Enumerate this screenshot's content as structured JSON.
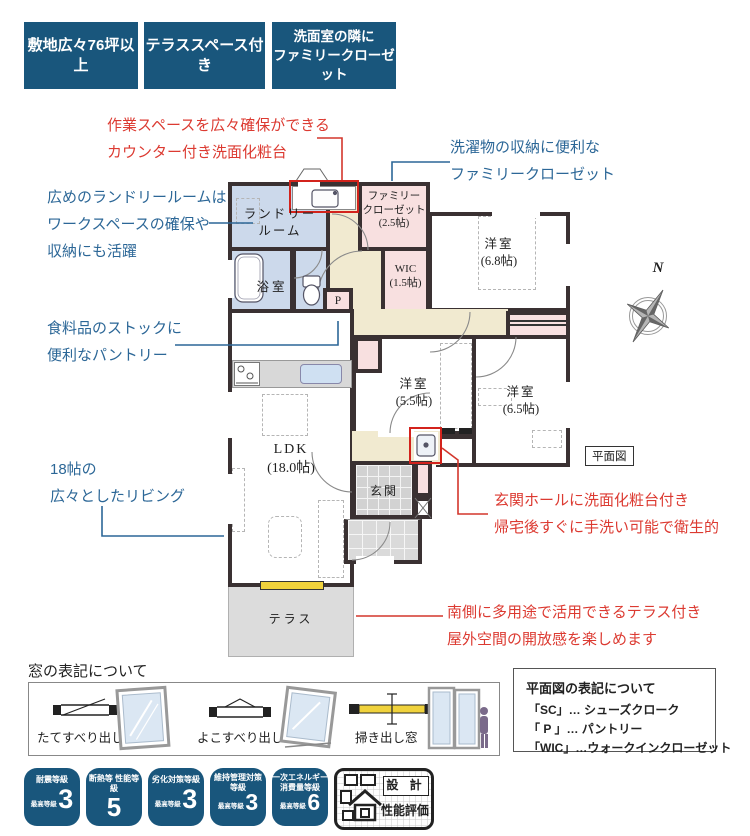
{
  "top_badges": [
    {
      "lines": [
        "敷地広々76坪以上"
      ]
    },
    {
      "lines": [
        "テラススペース付き"
      ]
    },
    {
      "lines": [
        "洗面室の隣に",
        "ファミリークローゼット"
      ]
    }
  ],
  "annotations": {
    "counter": [
      "作業スペースを広々確保ができる",
      "カウンター付き洗面化粧台"
    ],
    "family_closet": [
      "洗濯物の収納に便利な",
      "ファミリークローゼット"
    ],
    "laundry": [
      "広めのランドリールームは",
      "ワークスペースの確保や",
      "収納にも活躍"
    ],
    "pantry": [
      "食料品のストックに",
      "便利なパントリー"
    ],
    "living": [
      "18帖の",
      "広々としたリビング"
    ],
    "entrance": [
      "玄関ホールに洗面化粧台付き",
      "帰宅後すぐに手洗い可能で衛生的"
    ],
    "terrace": [
      "南側に多用途で活用できるテラス付き",
      "屋外空間の開放感を楽しめます"
    ]
  },
  "plan": {
    "caption": "平面図",
    "compass": "N",
    "rooms": {
      "laundry": [
        "ランドリー",
        "ルーム"
      ],
      "family_closet": [
        "ファミリー",
        "クローゼット",
        "(2.5帖)"
      ],
      "bath": "浴室",
      "pantry": "P",
      "wic": [
        "WIC",
        "(1.5帖)"
      ],
      "bed68": [
        "洋室",
        "(6.8帖)"
      ],
      "bed55": [
        "洋室",
        "(5.5帖)"
      ],
      "bed65": [
        "洋室",
        "(6.5帖)"
      ],
      "ldk": [
        "LDK",
        "(18.0帖)"
      ],
      "genkan": "玄関",
      "terrace": "テラス"
    }
  },
  "window_legend": {
    "title": "窓の表記について",
    "items": [
      "たてすべり出し窓",
      "よこすべり出し窓",
      "掃き出し窓"
    ]
  },
  "plan_legend": {
    "title": "平面図の表記について",
    "items": [
      "「SC」… シューズクローク",
      "「 P 」… パントリー",
      "「WIC」…ウォークインクローゼット"
    ]
  },
  "grade_badges": [
    {
      "label": [
        "耐震等級"
      ],
      "prefix": [
        "最高",
        "等級"
      ],
      "value": "3"
    },
    {
      "label": [
        "断熱等",
        "性能等級"
      ],
      "prefix": [],
      "value": "5"
    },
    {
      "label": [
        "劣化対策等級"
      ],
      "prefix": [
        "最高",
        "等級"
      ],
      "value": "3"
    },
    {
      "label": [
        "維持管理対策",
        "等級"
      ],
      "prefix": [
        "最高",
        "等級"
      ],
      "value": "3"
    },
    {
      "label": [
        "一次エネルギー",
        "消費量等級"
      ],
      "prefix": [
        "最高",
        "等級"
      ],
      "value": "6"
    }
  ],
  "cert_mark": {
    "top": "設 計",
    "bottom": "性能評価"
  },
  "colors": {
    "badge_blue": "#19567c",
    "annotation_red": "#dc3a31",
    "annotation_blue": "#2c6797",
    "wall": "#3a3132",
    "room_blue": "#ccd9eb",
    "room_pink": "#f8e0e0",
    "hall_cream": "#f1ead0",
    "tile_gray": "#d2d2d2",
    "terrace_gray": "#dcdcdc",
    "highlight_red": "#d3231c",
    "window_yellow": "#f0d23c"
  }
}
